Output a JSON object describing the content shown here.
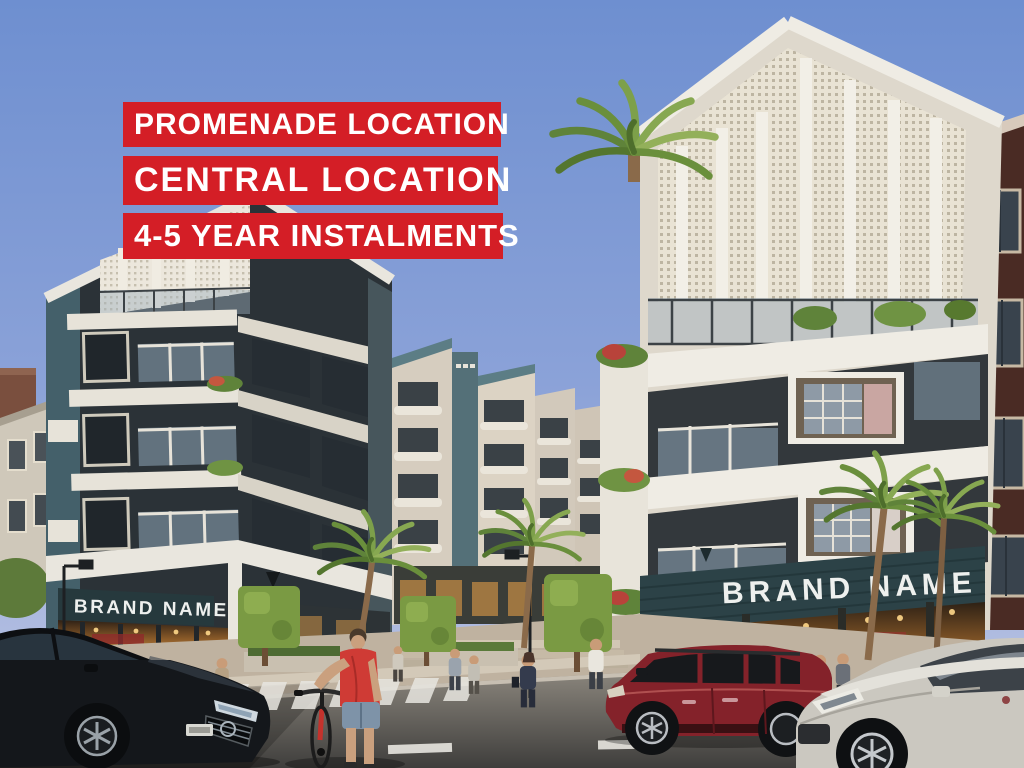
{
  "overlay": {
    "banners": [
      {
        "label": "PROMENADE LOCATION"
      },
      {
        "label": "CENTRAL LOCATION"
      },
      {
        "label": "4-5 YEAR INSTALMENTS"
      }
    ]
  },
  "storefronts": {
    "left_sign": "BRAND NAME",
    "right_sign": "BRAND NAME"
  },
  "colors": {
    "banner_red": "#d41e26",
    "banner_text": "#ffffff",
    "sky_top": "#6e8fd0",
    "sky_bottom": "#c2c9e4",
    "sign_bg": "#2c4247",
    "sign_text": "#eef0ee",
    "building_dark": "#2b3237",
    "building_light": "#efebe1",
    "accent_teal": "#54707a",
    "brick": "#4a2b24",
    "road": "#67655f",
    "sidewalk": "#bfb2a0",
    "red_suv": "#84222a",
    "silver_suv": "#cbc8c0",
    "black_car": "#14171b",
    "cyclist_shirt": "#cf3b35",
    "palm_green": "#6a8f3c"
  }
}
